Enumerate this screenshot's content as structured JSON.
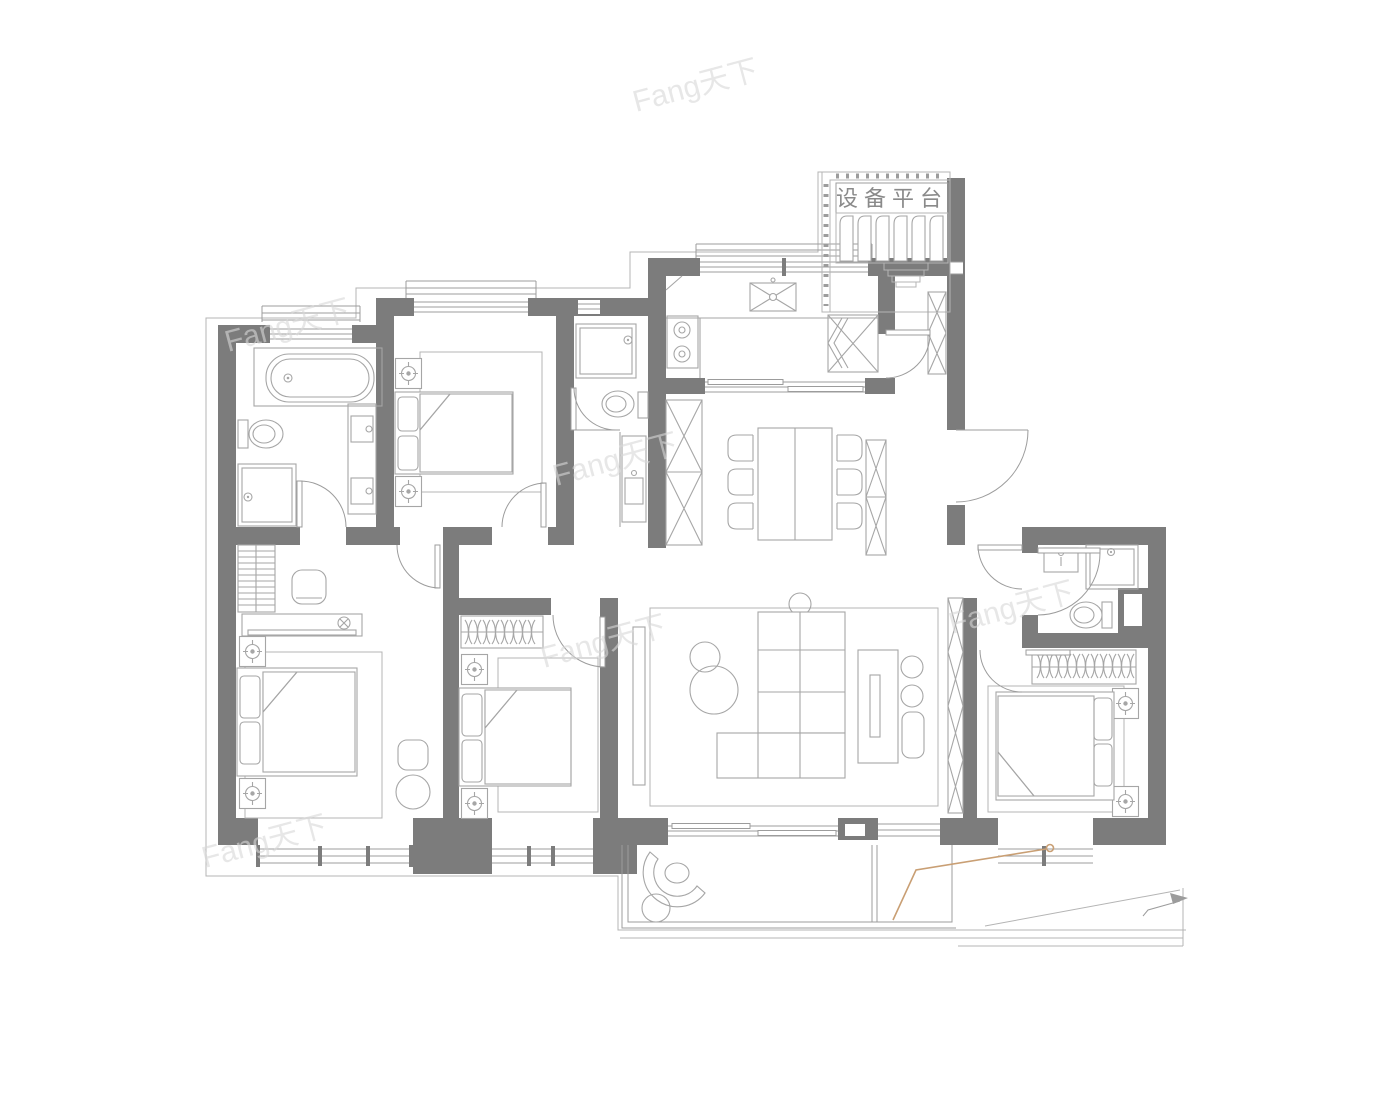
{
  "labels": {
    "equipment_platform": "设备平台"
  },
  "watermark": {
    "text": "Fang天下"
  },
  "colors": {
    "wall": "#7c7c7c",
    "line": "#9c9c9c",
    "furniture": "#a6a6a6",
    "thin": "#b4b4b4",
    "accent": "#c99f74",
    "watermark": "#d8d8d8",
    "label-text": "#8a8a8a",
    "background": "#ffffff"
  }
}
